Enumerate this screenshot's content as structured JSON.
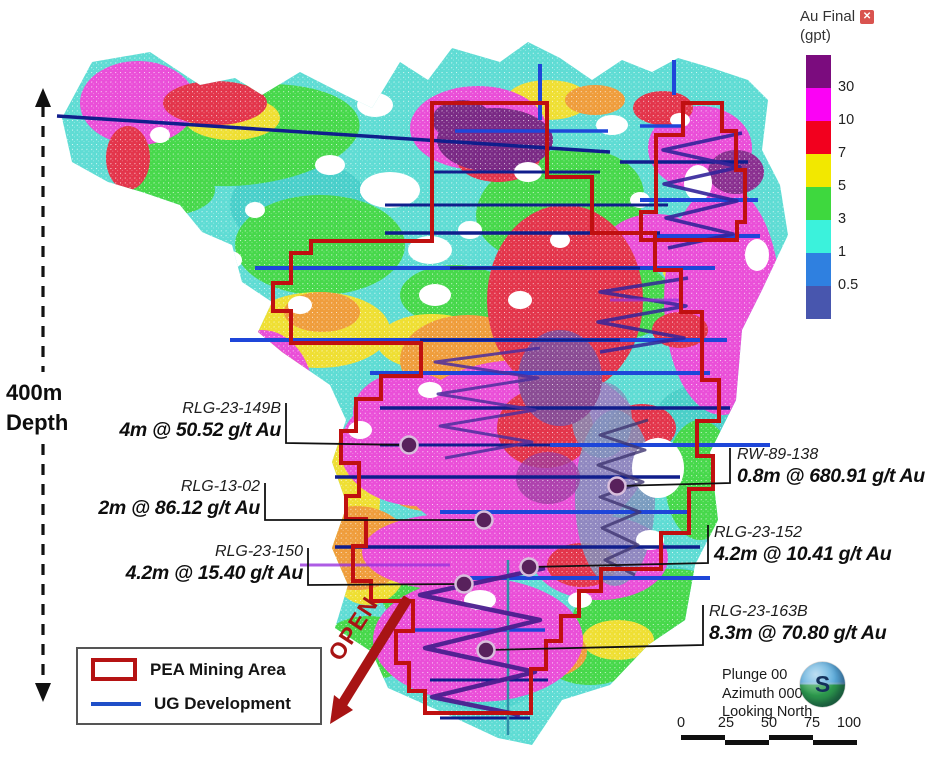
{
  "grade_legend": {
    "title": "Au Final",
    "units": "(gpt)",
    "close_icon": "✕",
    "bands": [
      {
        "color": "#7B0C7E",
        "label": "30"
      },
      {
        "color": "#FB02F5",
        "label": "10"
      },
      {
        "color": "#F2001E",
        "label": "7"
      },
      {
        "color": "#F2E800",
        "label": "5"
      },
      {
        "color": "#3ED83E",
        "label": "3"
      },
      {
        "color": "#3BF2DC",
        "label": "1"
      },
      {
        "color": "#2F80E0",
        "label": "0.5"
      },
      {
        "color": "#4856AE",
        "label": ""
      }
    ]
  },
  "depth_scale": {
    "line1": "400m",
    "line2": "Depth"
  },
  "callouts": {
    "left": [
      {
        "hole_id": "RLG-23-149B",
        "intercept": "4m @ 50.52 g/t Au"
      },
      {
        "hole_id": "RLG-13-02",
        "intercept": "2m @ 86.12 g/t Au"
      },
      {
        "hole_id": "RLG-23-150",
        "intercept": "4.2m @ 15.40 g/t Au"
      }
    ],
    "right": [
      {
        "hole_id": "RW-89-138",
        "intercept": "0.8m @ 680.91 g/t Au"
      },
      {
        "hole_id": "RLG-23-152",
        "intercept": "4.2m @ 10.41 g/t Au"
      },
      {
        "hole_id": "RLG-23-163B",
        "intercept": "8.3m @ 70.80 g/t Au"
      }
    ]
  },
  "annotations": {
    "open_label": "OPEN"
  },
  "map_legend": {
    "pea_label": "PEA Mining Area",
    "ug_label": "UG Development"
  },
  "view_info": {
    "plunge": "Plunge 00",
    "azimuth": "Azimuth 000",
    "looking": "Looking North",
    "globe_letter": "S"
  },
  "scale_bar": {
    "ticks": [
      "0",
      "25",
      "50",
      "75",
      "100"
    ]
  },
  "colors": {
    "pea_outline": "#C01010",
    "ug_line_bright": "#1E46D9",
    "ug_line_dark": "#101E8C",
    "open_arrow": "#A81414",
    "decline_trace": "#4B2E9E",
    "marker_fill": "#58215C"
  }
}
